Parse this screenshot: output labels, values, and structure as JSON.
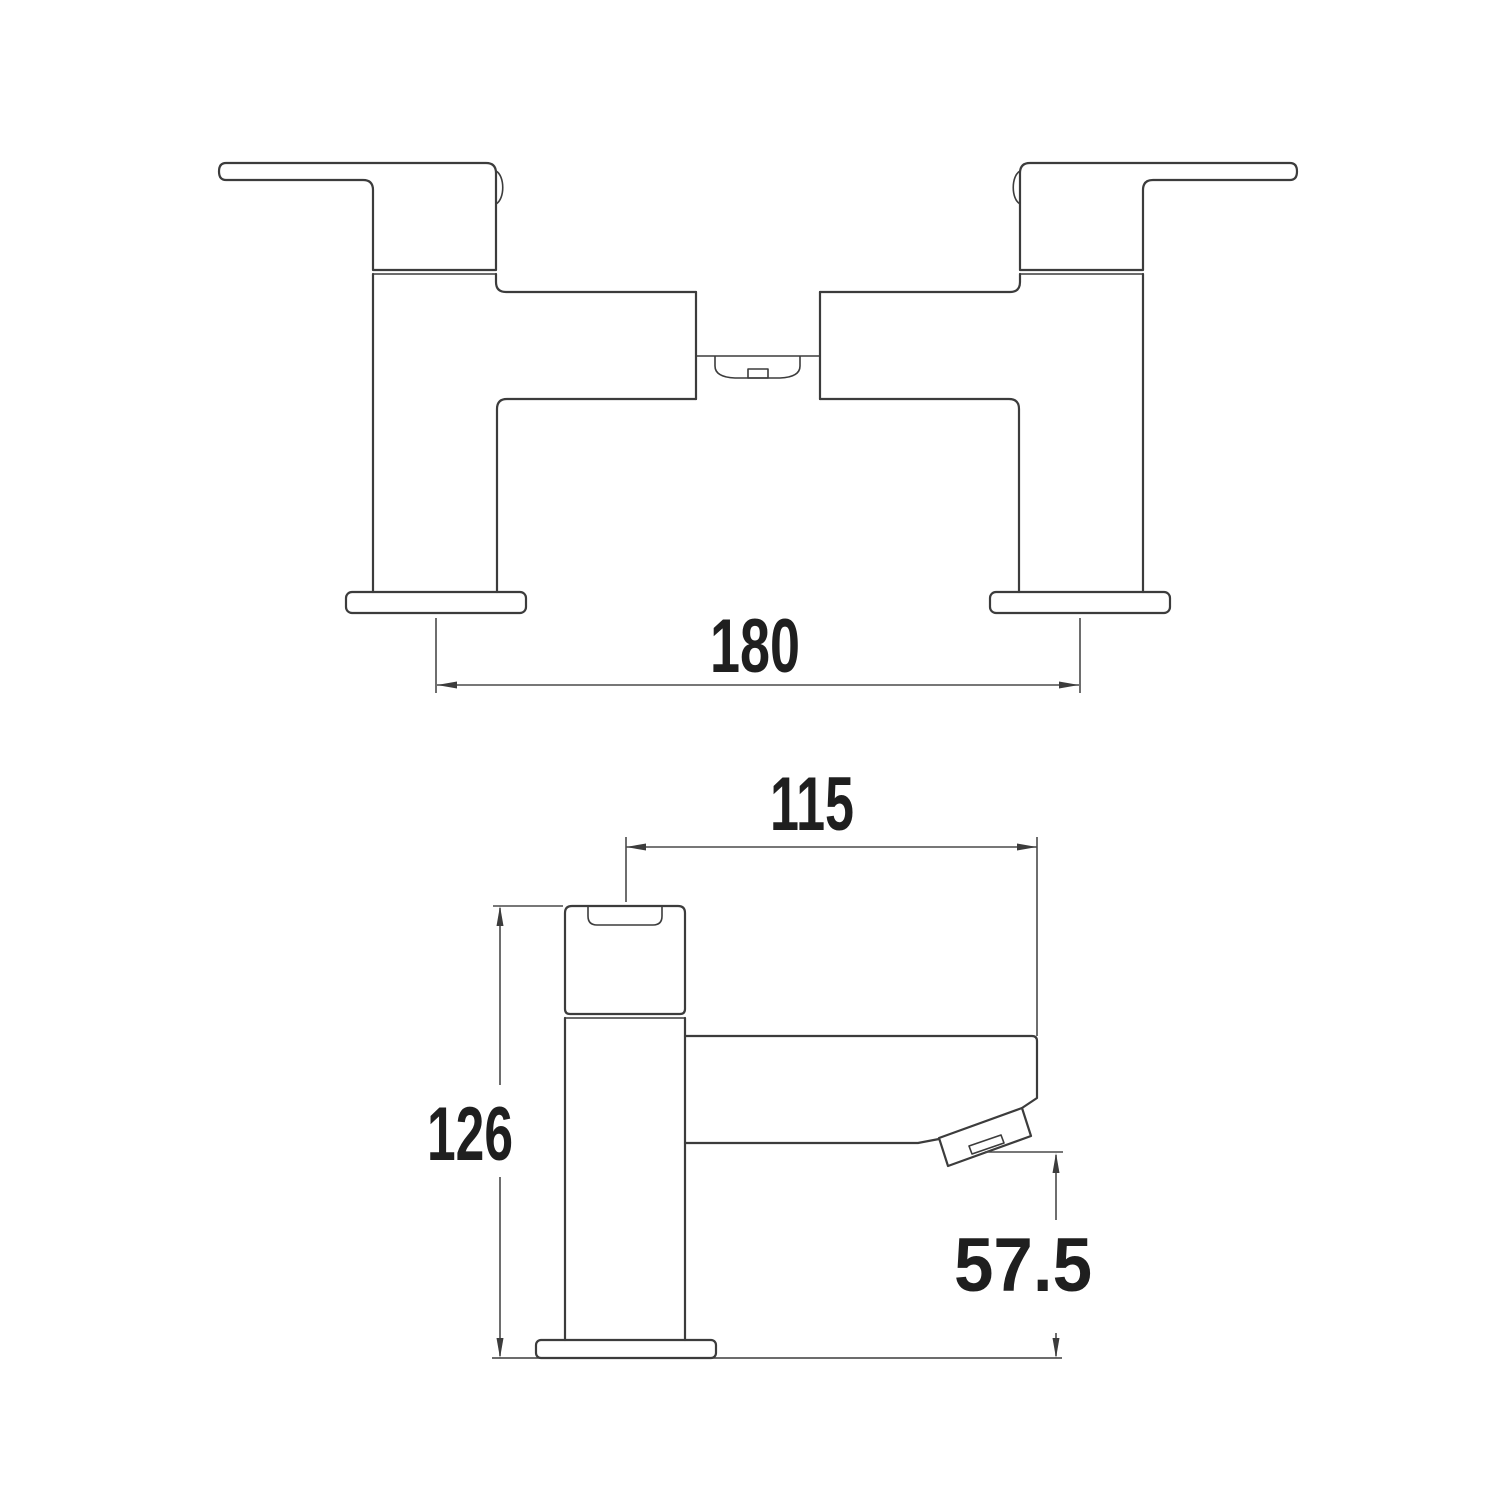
{
  "page": {
    "background": "#ffffff"
  },
  "drawing": {
    "line_color": "#3c3c3c",
    "dimension_line_color": "#4a4a4a",
    "text_color": "#1f1f1f"
  },
  "dimensions": {
    "front_width": "180",
    "side_depth": "115",
    "side_height": "126",
    "spout_outlet_height": "57.5"
  }
}
